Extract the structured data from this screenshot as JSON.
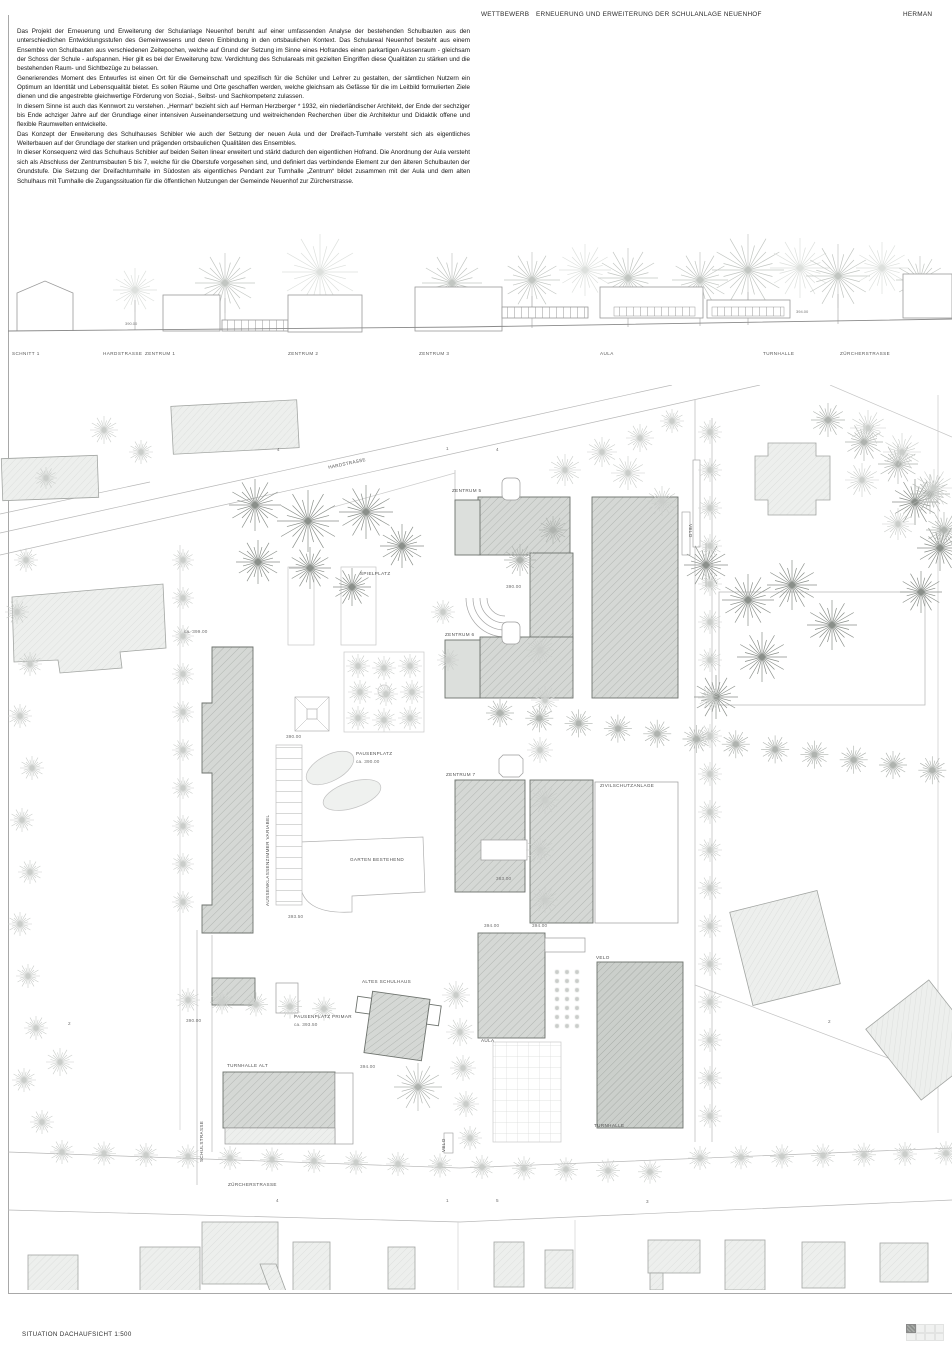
{
  "header": {
    "competition_label": "WETTBEWERB",
    "project_title": "ERNEUERUNG UND ERWEITERUNG DER SCHULANLAGE NEUENHOF",
    "author_code": "HERMAN"
  },
  "description": {
    "paragraphs": [
      "Das Projekt der Erneuerung und Erweiterung der Schulanlage Neuenhof beruht auf einer umfassenden Analyse der bestehenden Schulbauten aus den unterschiedlichen Entwicklungsstufen des Gemeinwesens und deren Einbindung in den ortsbaulichen Kontext. Das Schulareal Neuenhof besteht aus einem Ensemble von Schulbauten aus verschiedenen Zeitepochen, welche auf Grund der Setzung im Sinne eines Hofrandes einen parkartigen Aussenraum - gleichsam der Schoss der Schule - aufspannen. Hier gilt es bei der Erweiterung bzw. Verdichtung des Schulareals mit gezielten Eingriffen diese Qualitäten zu stärken und die bestehenden Raum- und Sichtbezüge zu belassen.",
      "Generierendes Moment des Entwurfes ist einen Ort für die Gemeinschaft und spezifisch für die Schüler und Lehrer zu gestalten, der sämtlichen Nutzern ein Optimum an Identität und Lebensqualität bietet. Es sollen Räume und Orte geschaffen werden, welche gleichsam als Gefässe für die im Leitbild formulierten Ziele dienen und die angestrebte gleichwertige Förderung von Sozial-, Selbst- und Sachkompetenz zulassen.",
      "In diesem Sinne ist auch das Kennwort zu verstehen. „Herman“ bezieht sich auf Herman Herzberger * 1932, ein niederländischer Architekt, der Ende der sechziger bis Ende achziger Jahre auf der Grundlage einer intensiven Auseinandersetzung und weitreichenden Recherchen über die Architektur und Didaktik offene und flexible Raumwelten entwickelte.",
      "Das Konzept der Erweiterung des Schulhauses Schibler wie auch der Setzung der neuen Aula und der Dreifach-Turnhalle versteht sich als eigentliches Weiterbauen auf der Grundlage der starken und prägenden ortsbaulichen Qualitäten des Ensembles.",
      "In dieser Konsequenz wird das Schulhaus Schibler auf beiden Seiten linear erweitert und stärkt dadurch den eigentlichen Hofrand. Die Anordnung der Aula versteht sich als Abschluss der Zentrumsbauten 5 bis 7, welche für die Oberstufe vorgesehen sind, und definiert das verbindende Element zur den älteren Schulbauten der Grundstufe. Die Setzung der Dreifachturnhalle im Südosten als eigentliches Pendant zur Turnhalle „Zentrum“ bildet zusammen mit der Aula und dem alten Schulhaus mit Turnhalle die Zugangssituation für die öffentlichen Nutzungen der Gemeinde Neuenhof zur Zürcherstrasse."
    ]
  },
  "section": {
    "axis_labels": [
      "SCHNITT 1",
      "HARDSTRASSE",
      "ZENTRUM 1",
      "ZENTRUM 2",
      "ZENTRUM 3",
      "AULA",
      "TURNHALLE",
      "ZÜRCHERSTRASSE"
    ],
    "elevation_marks": [
      "390.00",
      "394.00"
    ]
  },
  "plan": {
    "labels": [
      "HARDSTRASSE",
      "4",
      "1",
      "4",
      "ZENTRUM 5",
      "VELO",
      "SPIELPLATZ",
      "390.00",
      "ca. 399.00",
      "ZENTRUM 6",
      "390.00",
      "PAUSENPLATZ",
      "ca. 390.00",
      "ZENTRUM 7",
      "ZIVILSCHUTZANLAGE",
      "AUSSENKLASSENZIMMER VARIABEL",
      "GARTEN BESTEHEND",
      "383.00",
      "393.50",
      "394.00",
      "394.00",
      "VELO",
      "ALTES SCHULHAUS",
      "390.00",
      "PAUSENPLATZ PRIMAR",
      "ca. 393.50",
      "AULA",
      "TURNHALLE ALT",
      "394.00",
      "2",
      "2",
      "SCHULSTRASSE",
      "VELO",
      "TURNHALLE",
      "ZÜRCHERSTRASSE",
      "4",
      "1",
      "5",
      "3"
    ]
  },
  "footer": {
    "caption": "SITUATION DACHAUFSICHT  1:500"
  },
  "colors": {
    "sheet_line": "#a8a8a8",
    "building_new_fill": "#d5d8d5",
    "building_existing_fill": "#edefed",
    "tree_dark": "#8a8f8a",
    "tree_light": "#cacdca",
    "text": "#1f1f1f"
  }
}
